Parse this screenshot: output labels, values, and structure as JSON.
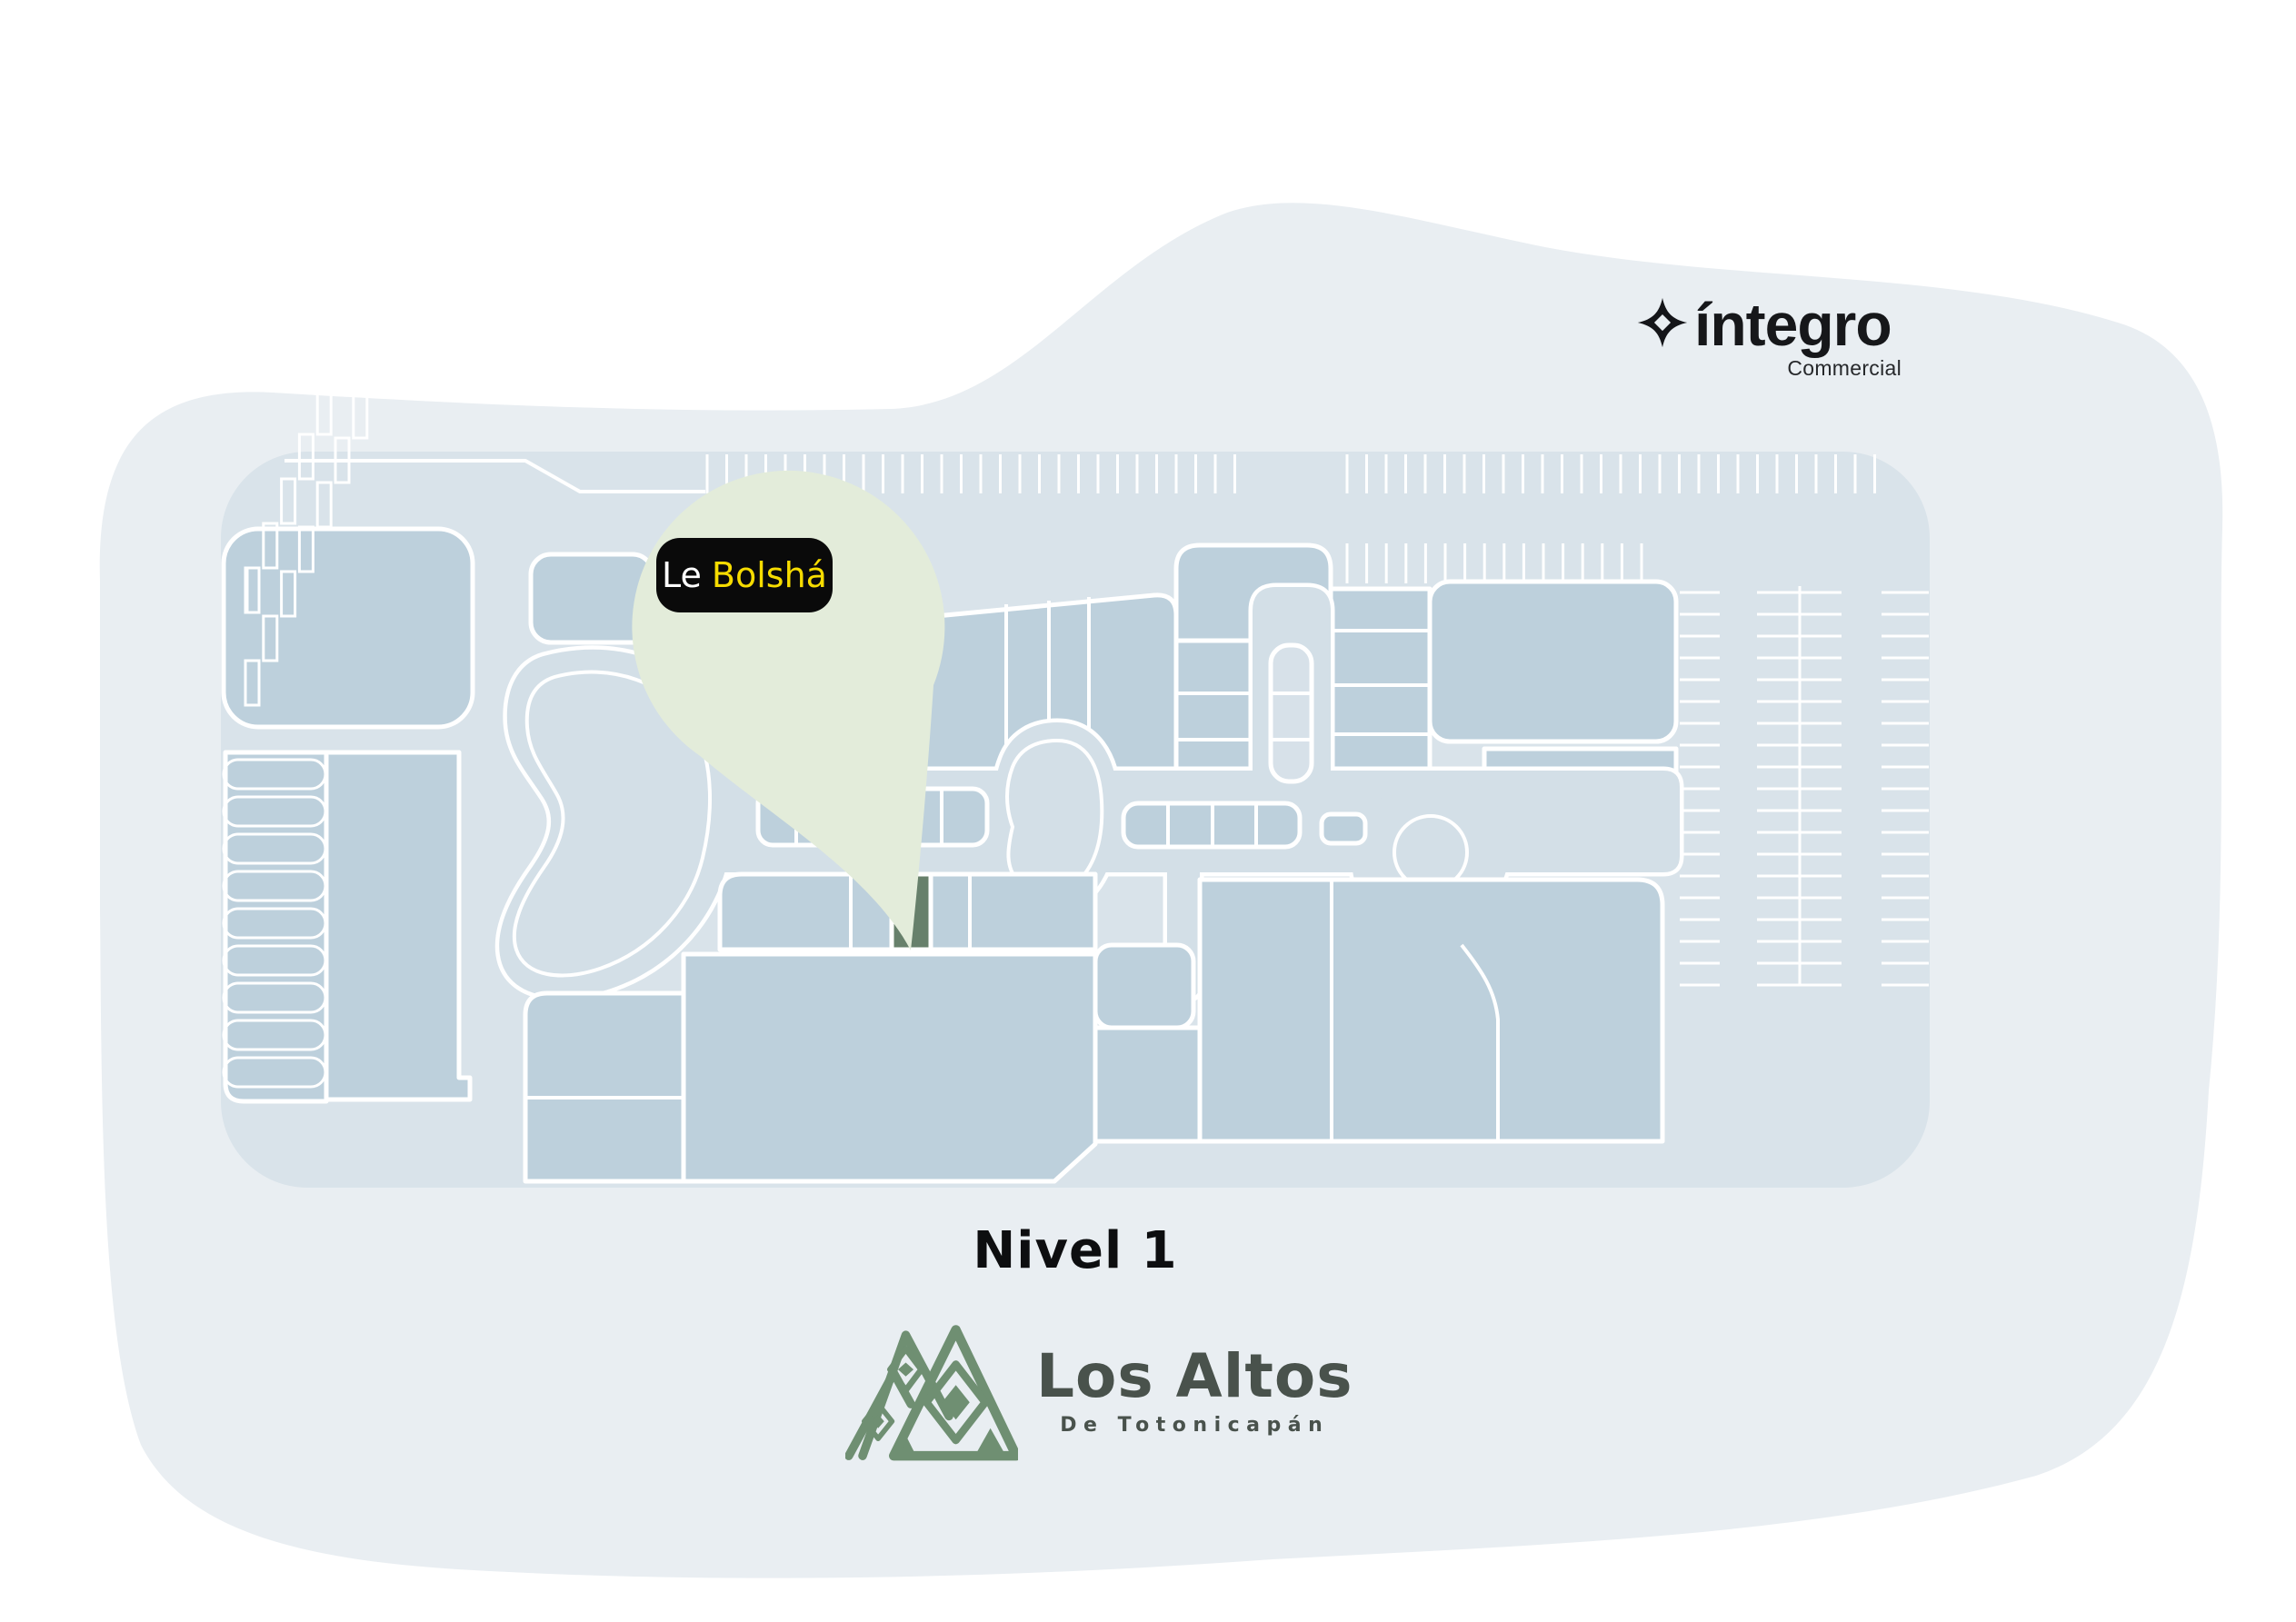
{
  "brand": {
    "name": "íntegro",
    "division": "Commercial"
  },
  "map": {
    "level_label": "Nivel 1",
    "pin": {
      "store_prefix": "Le",
      "store_name": "Bolshá"
    },
    "highlighted_store": "Le Bolshá"
  },
  "footer": {
    "mall_name": "Los Altos",
    "mall_subtitle": "De Totonicapán"
  },
  "colors": {
    "background_blob": "#E9EEF2",
    "site_base": "#D9E3EA",
    "building": "#BDD0DC",
    "walkway": "#D3DFE7",
    "outline": "#FFFFFF",
    "highlight_green": "#67806B",
    "pin_fill": "#E3ECDA",
    "label_background": "#0A0A0A",
    "label_yellow": "#F6DC00",
    "heading_text": "#0D0E10",
    "logo_mountain_green": "#6F8F72",
    "logo_text": "#49524C",
    "brand_text": "#16171A"
  }
}
